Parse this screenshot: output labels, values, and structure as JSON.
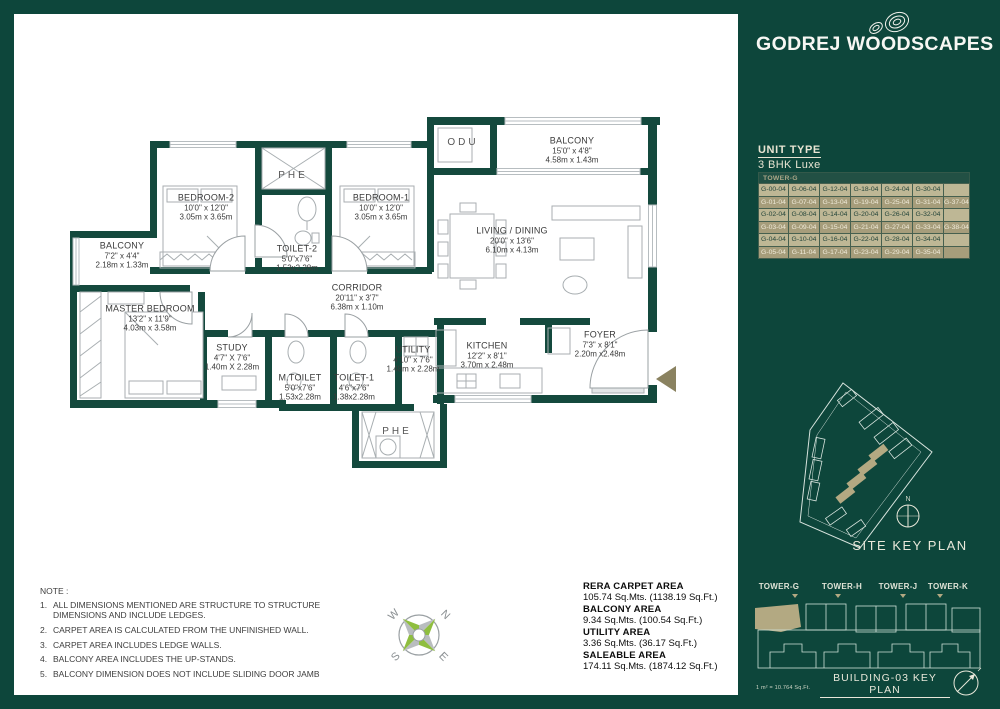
{
  "brand": {
    "logo_text": "GODREJ WOODSCAPES"
  },
  "unit_info": {
    "label": "UNIT TYPE",
    "value": "3 BHK Luxe"
  },
  "unit_table": {
    "header": "TOWER-G",
    "rows": [
      [
        "G-00-04",
        "G-06-04",
        "G-12-04",
        "G-18-04",
        "G-24-04",
        "G-30-04",
        ""
      ],
      [
        "G-01-04",
        "G-07-04",
        "G-13-04",
        "G-19-04",
        "G-25-04",
        "G-31-04",
        "G-37-04"
      ],
      [
        "G-02-04",
        "G-08-04",
        "G-14-04",
        "G-20-04",
        "G-26-04",
        "G-32-04",
        ""
      ],
      [
        "G-03-04",
        "G-09-04",
        "G-15-04",
        "G-21-04",
        "G-27-04",
        "G-33-04",
        "G-38-04"
      ],
      [
        "G-04-04",
        "G-10-04",
        "G-16-04",
        "G-22-04",
        "G-28-04",
        "G-34-04",
        ""
      ],
      [
        "G-05-04",
        "G-11-04",
        "G-17-04",
        "G-23-04",
        "G-29-04",
        "G-35-04",
        ""
      ]
    ]
  },
  "plan": {
    "rooms": [
      {
        "id": "bedroom-2",
        "name": "BEDROOM-2",
        "ft": "10'0\" x 12'0\"",
        "m": "3.05m x 3.65m"
      },
      {
        "id": "phe-top",
        "name": "PHE",
        "ft": "",
        "m": ""
      },
      {
        "id": "toilet-2",
        "name": "TOILET-2",
        "ft": "5'0\"x7'6\"",
        "m": "1.53x2.28m"
      },
      {
        "id": "bedroom-1",
        "name": "BEDROOM-1",
        "ft": "10'0\" x 12'0\"",
        "m": "3.05m x 3.65m"
      },
      {
        "id": "odu",
        "name": "ODU",
        "ft": "",
        "m": ""
      },
      {
        "id": "balcony-top",
        "name": "BALCONY",
        "ft": "15'0\" x 4'8\"",
        "m": "4.58m x 1.43m"
      },
      {
        "id": "living-dining",
        "name": "LIVING / DINING",
        "ft": "20'0\" x 13'6\"",
        "m": "6.10m x 4.13m"
      },
      {
        "id": "balcony-left",
        "name": "BALCONY",
        "ft": "7'2\" x 4'4\"",
        "m": "2.18m x 1.33m"
      },
      {
        "id": "master-bedroom",
        "name": "MASTER BEDROOM",
        "ft": "13'2\" x 11'9\"",
        "m": "4.03m x 3.58m"
      },
      {
        "id": "study",
        "name": "STUDY",
        "ft": "4'7\" X 7'6\"",
        "m": "1.40m X 2.28m"
      },
      {
        "id": "corridor",
        "name": "CORRIDOR",
        "ft": "20'11\" x 3'7\"",
        "m": "6.38m x 1.10m"
      },
      {
        "id": "m-toilet",
        "name": "M.TOILET",
        "ft": "5'0\"x7'6\"",
        "m": "1.53x2.28m"
      },
      {
        "id": "toilet-1",
        "name": "TOILET-1",
        "ft": "4'6\"x7'6\"",
        "m": "1.38x2.28m"
      },
      {
        "id": "utility",
        "name": "UTILITY",
        "ft": "4'10\" x 7'6\"",
        "m": "1.48m x 2.28m"
      },
      {
        "id": "kitchen",
        "name": "KITCHEN",
        "ft": "12'2\" x 8'1\"",
        "m": "3.70m x 2.48m"
      },
      {
        "id": "foyer",
        "name": "FOYER",
        "ft": "7'3\" x 8'1\"",
        "m": "2.20m x2.48m"
      },
      {
        "id": "phe-bottom",
        "name": "PHE",
        "ft": "",
        "m": ""
      }
    ],
    "compass": {
      "n": "N",
      "e": "E",
      "s": "S",
      "w": "W"
    }
  },
  "notes": {
    "title": "NOTE :",
    "items": [
      "ALL DIMENSIONS MENTIONED ARE STRUCTURE TO STRUCTURE DIMENSIONS AND INCLUDE LEDGES.",
      "CARPET AREA IS CALCULATED FROM THE UNFINISHED WALL.",
      "CARPET AREA INCLUDES LEDGE WALLS.",
      "BALCONY AREA INCLUDES THE UP-STANDS.",
      "BALCONY DIMENSION DOES NOT INCLUDE SLIDING DOOR JAMB"
    ]
  },
  "areas": [
    {
      "label": "RERA CARPET AREA",
      "value": "105.74 Sq.Mts. (1138.19 Sq.Ft.)"
    },
    {
      "label": "BALCONY  AREA",
      "value": "9.34 Sq.Mts. (100.54 Sq.Ft.)"
    },
    {
      "label": "UTILITY AREA",
      "value": "3.36 Sq.Mts. (36.17 Sq.Ft.)"
    },
    {
      "label": "SALEABLE AREA",
      "value": "174.11 Sq.Mts. (1874.12 Sq.Ft.)"
    }
  ],
  "site_key_plan": {
    "title": "SITE KEY PLAN",
    "north_label": "N"
  },
  "building_key_plan": {
    "towers": [
      "TOWER-G",
      "TOWER-H",
      "TOWER-J",
      "TOWER-K"
    ],
    "title": "BUILDING-03 KEY PLAN",
    "scale_note": "1 m² = 10.764 Sq.Ft."
  },
  "colors": {
    "brand_green": "#0d463b",
    "wall_green": "#14493d",
    "tan_highlight": "#b3a982",
    "table_light": "#beb795",
    "table_dark": "#a69d7b",
    "compass_green": "#8fbe3f",
    "compass_gray": "#b9bdbf"
  }
}
